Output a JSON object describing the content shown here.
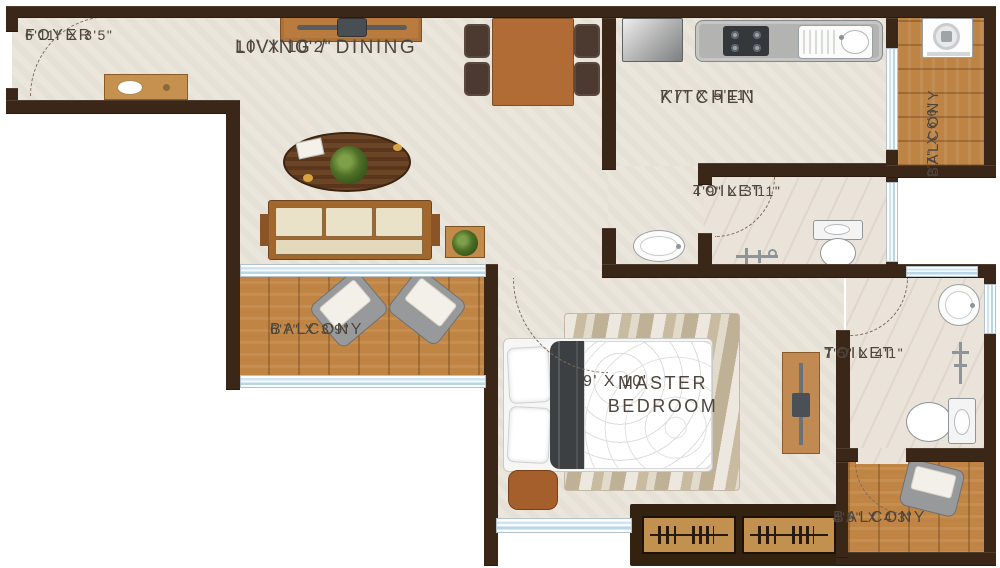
{
  "rooms": [
    {
      "id": "foyer",
      "name": "FOYER",
      "dimensions": "6'11\" X 3'5\""
    },
    {
      "id": "living-dining",
      "name": "LIVING / DINING",
      "dimensions": "10' X 10'2\""
    },
    {
      "id": "kitchen",
      "name": "KITCHEN",
      "dimensions": "7'7\" X 5'11\""
    },
    {
      "id": "balcony-utility",
      "name": "BALCONY",
      "dimensions": "2'7\" X 6'6\""
    },
    {
      "id": "toilet-common",
      "name": "TOILET",
      "dimensions": "4'9\" X 3'11\""
    },
    {
      "id": "balcony-living",
      "name": "BALCONY",
      "dimensions": "6'7\" X 3'9\""
    },
    {
      "id": "master-bedroom",
      "name": "MASTER BEDROOM",
      "dimensions": "9' X 10'"
    },
    {
      "id": "toilet-master",
      "name": "TOILET",
      "dimensions": "7'5\" X 4'1\""
    },
    {
      "id": "balcony-master",
      "name": "BALCONY",
      "dimensions": "4'5\" X 4'3\""
    }
  ],
  "furniture_icons": [
    "shoe-cabinet",
    "tv-console",
    "dining-table",
    "dining-chair",
    "coffee-table",
    "sofa",
    "planter",
    "refrigerator",
    "gas-hob",
    "kitchen-sink",
    "washing-machine",
    "water-closet",
    "shower",
    "wash-basin",
    "armchair",
    "double-bed",
    "area-rug",
    "ottoman",
    "tv-panel",
    "sliding-wardrobe",
    "door-swing"
  ],
  "colors": {
    "wall": "#3b2718",
    "floor": "#ebe6dc",
    "toilet_floor": "#eae3da",
    "balcony_wood": "#c08544",
    "window_glass": "#cfe4f0",
    "furniture_wood": "#c18a4c",
    "label_text": "#4e463e"
  }
}
